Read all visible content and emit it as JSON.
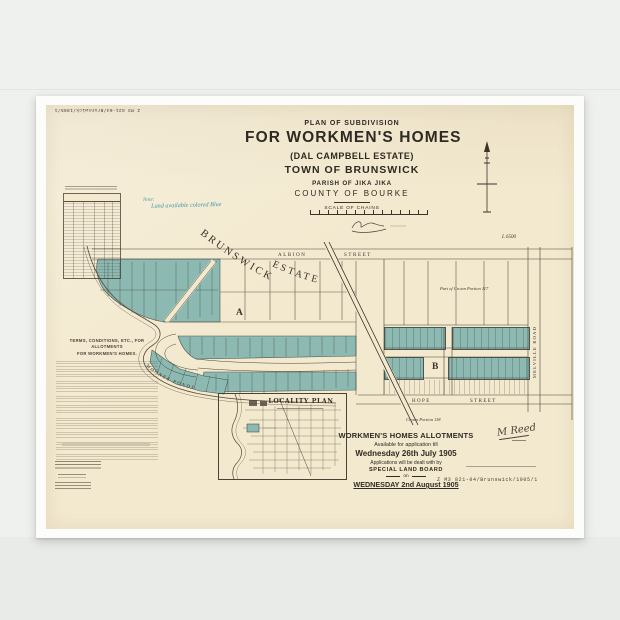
{
  "catalog": {
    "code": "Z M3 821-04/Brunswick/1905/1"
  },
  "title": {
    "plan": "PLAN OF SUBDIVISION",
    "main": "FOR WORKMEN'S HOMES",
    "estate": "(DAL CAMPBELL ESTATE)",
    "town": "TOWN OF BRUNSWICK",
    "parish": "PARISH OF JIKA JIKA",
    "county": "COUNTY OF BOURKE",
    "scale": "SCALE OF CHAINS"
  },
  "note": {
    "label": "Note:",
    "text": "Land available colored Blue"
  },
  "map": {
    "estate_word1": "BRUNSWICK",
    "estate_word2": "ESTATE",
    "albion": "ALBION",
    "albion_st": "STREET",
    "hope": "HOPE",
    "hope_st": "STREET",
    "melville": "MELVILLE ROAD",
    "creek": "MOONEE PONDS",
    "section_a": "A",
    "section_b": "B",
    "parcel_ne": "L 6500",
    "crown_ne": "Part of Crown Portion 117",
    "crown_s": "Crown Portion 118"
  },
  "terms": {
    "heading1": "TERMS, CONDITIONS, ETC., FOR ALLOTMENTS",
    "heading2": "FOR WORKMEN'S HOMES."
  },
  "inset": {
    "title": "LOCALITY PLAN"
  },
  "notice": {
    "l1": "WORKMEN'S HOMES ALLOTMENTS",
    "l2": "Available for application till",
    "l3": "Wednesday 26th July 1905",
    "l4": "Applications will be dealt with by",
    "l5": "SPECIAL LAND BOARD",
    "l6": "on",
    "l7": "WEDNESDAY 2nd August 1905"
  },
  "signature": "M Reed",
  "colors": {
    "paper": "#f3e9cf",
    "allotment_teal": "#8cbab2",
    "note_blue": "#3f98a8",
    "ink": "#3a332a"
  }
}
